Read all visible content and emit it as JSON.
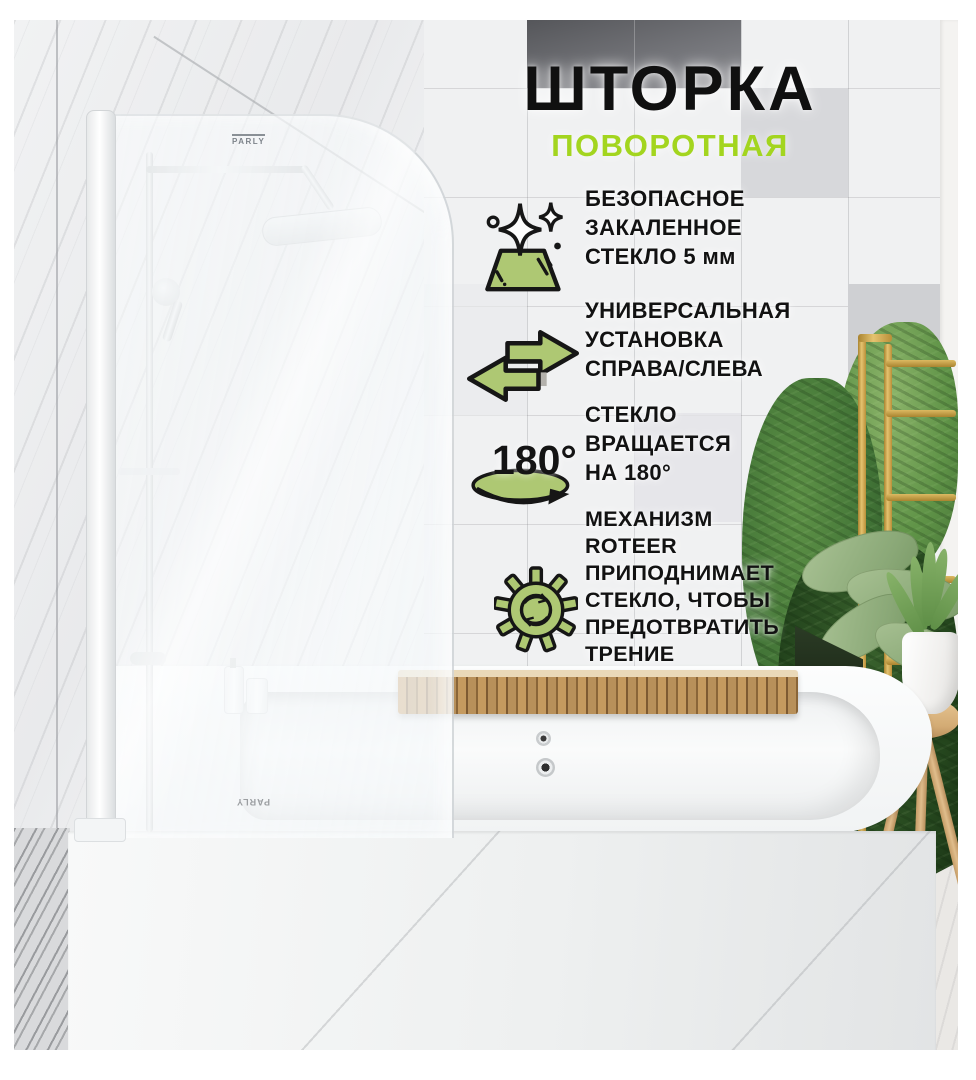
{
  "title": "ШТОРКА",
  "subtitle": "ПОВОРОТНАЯ",
  "features": [
    {
      "icon": "sparkling-glass-icon",
      "lines": [
        "БЕЗОПАСНОЕ",
        "ЗАКАЛЕННОЕ",
        "СТЕКЛО 5 мм"
      ]
    },
    {
      "icon": "left-right-arrows-icon",
      "lines": [
        "УНИВЕРСАЛЬНАЯ",
        "УСТАНОВКА",
        "СПРАВА/СЛЕВА"
      ]
    },
    {
      "icon": "rotate-180-icon",
      "lines": [
        "СТЕКЛО",
        "ВРАЩАЕТСЯ",
        "НА 180°"
      ]
    },
    {
      "icon": "gear-icon",
      "lines": [
        "МЕХАНИЗМ",
        "ROTEER",
        "ПРИПОДНИМАЕТ",
        "СТЕКЛО, ЧТОБЫ",
        "ПРЕДОТВРАТИТЬ",
        "ТРЕНИЕ"
      ]
    }
  ],
  "rotation_icon_label": "180°",
  "brand_marks": {
    "shower_glass": "PARLY",
    "bath_front": "PARLY"
  },
  "colors": {
    "accent_green": "#a3d51f",
    "icon_green": "#aec873",
    "text_black": "#121212"
  }
}
